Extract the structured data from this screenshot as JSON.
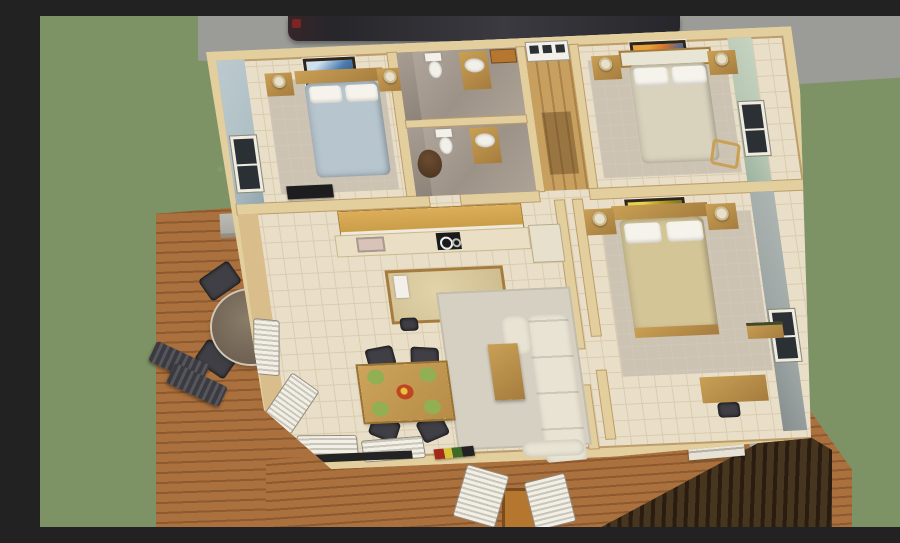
{
  "scene": {
    "title": "Aerial 3D dollhouse rendering of a single-storey home floor plan",
    "setting": "Cutaway house viewed from above on a green lawn, with concrete driveway and parked car at top, wooden side deck with patio set at left, and a front porch at bottom"
  },
  "palette": {
    "grass": "#7E9365",
    "concrete": "#9B9B97",
    "car": "#26262B",
    "deckA": "#AA703D",
    "deckB": "#8C5A2E",
    "floor": "#E9DFC9",
    "grout": "#D9CBAD",
    "wallCap": "#E3CE9D",
    "wallEdge": "#BC9D6B",
    "wallFace": "#D9BE8C",
    "blueWall": "#AFC0C5",
    "greenWall": "#B9C8B4",
    "greyWall": "#9EA7A5",
    "woodFurn": "#C9A055",
    "woodDark": "#A67C3E",
    "bedBlue": "#B7C5CE",
    "bedCream": "#D9D3BD",
    "bedTan": "#D4C597",
    "white": "#F2F0E8",
    "sofa": "#E8E3D3",
    "carpet": "#CCC3B3",
    "chairDark": "#3F3F45",
    "plateGreen": "#93AF53",
    "dishRed": "#C04522",
    "paneDark": "#2B3034",
    "siding": "#46351F",
    "sidingDark": "#2A1D10",
    "glassTable": "#6E6152",
    "porchTable": "#B5772F",
    "rug": "#D5D0C2",
    "tvDark": "#232323",
    "lampShade": "#E8E0C8"
  },
  "rooms": {
    "bedroom1": {
      "name": "Bedroom 1 (top left)",
      "furniture": [
        "double bed with light blue bedding",
        "wood headboard",
        "two nightstands with lamps",
        "framed picture on top wall",
        "dark dresser",
        "window on blue-grey accent wall"
      ]
    },
    "bathroom1": {
      "name": "Bathroom (upper)",
      "furniture": [
        "toilet",
        "wood vanity with white sink",
        "small wood cabinet"
      ]
    },
    "bathroom2": {
      "name": "Bathroom (lower)",
      "furniture": [
        "toilet",
        "wood vanity with white sink",
        "brown dog figure"
      ]
    },
    "entry": {
      "name": "Entry hall",
      "furniture": [
        "white front door with three dark panes",
        "wood plank floor",
        "dark floor runner"
      ]
    },
    "bedroom2": {
      "name": "Bedroom 2 (top right)",
      "furniture": [
        "double bed with cream bedding",
        "two nightstands with lamps",
        "orange and blue framed art",
        "window on pale green wall",
        "wooden chair"
      ]
    },
    "bedroom3": {
      "name": "Bedroom 3 (right)",
      "furniture": [
        "double bed with tan bedding",
        "wood foot-board",
        "two nightstands with lamps",
        "gold framed art",
        "desk with dark chair",
        "bench",
        "window on grey wall"
      ]
    },
    "living": {
      "name": "Kitchen / dining / living room",
      "furniture": [
        "upper wood cabinets",
        "counter with sink and black cooktop",
        "refrigerator",
        "kitchen island with towel and stool",
        "dining table with four dark chairs, four green place settings and red centerpiece",
        "grey area rug",
        "L-shaped cream sectional sofa",
        "wood coffee table",
        "corner windows with white blinds",
        "bottom wall windows with white blinds",
        "dark TV console",
        "colorful magazines on floor"
      ]
    }
  },
  "exterior": {
    "features": [
      "green lawn",
      "concrete driveway",
      "dark parked car",
      "wooden side deck",
      "grey outdoor counter on deck",
      "round glass patio table",
      "four dark patio chairs",
      "two dark sun loungers",
      "front porch decking",
      "two white porch chairs",
      "wooden porch side table",
      "white porch steps",
      "dark wood front siding",
      "grey exterior side wall"
    ]
  }
}
